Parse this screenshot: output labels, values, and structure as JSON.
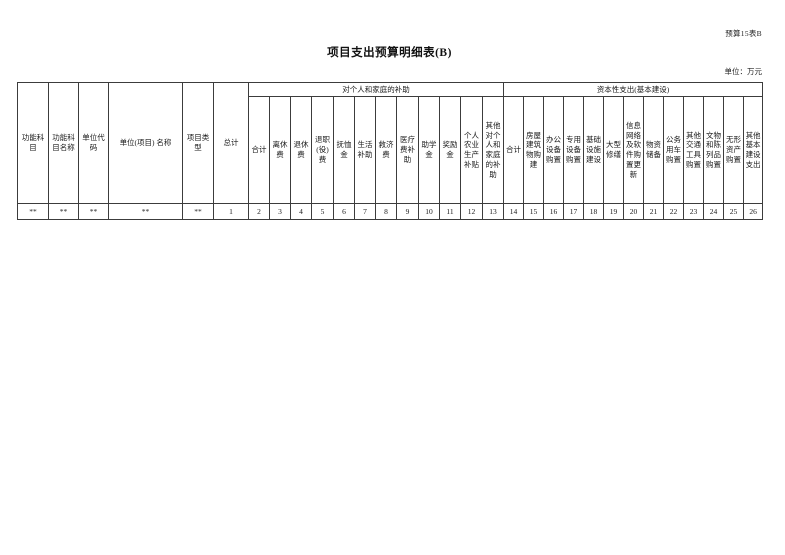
{
  "page": {
    "doc_label": "预算15表B",
    "title": "项目支出预算明细表(B)",
    "unit_note": "单位：万元"
  },
  "table": {
    "fixed_columns": [
      {
        "label": "功能科目",
        "index": "**"
      },
      {
        "label": "功能科目名称",
        "index": "**"
      },
      {
        "label": "单位代码",
        "index": "**"
      },
      {
        "label": "单位(项目) 名称",
        "index": "**"
      },
      {
        "label": "项目类型",
        "index": "**"
      },
      {
        "label": "总计",
        "index": "1"
      }
    ],
    "groups": [
      {
        "label": "对个人和家庭的补助",
        "columns": [
          {
            "label": "合计",
            "index": "2"
          },
          {
            "label": "离休费",
            "index": "3"
          },
          {
            "label": "退休费",
            "index": "4"
          },
          {
            "label": "退职(役)费",
            "index": "5"
          },
          {
            "label": "抚恤金",
            "index": "6"
          },
          {
            "label": "生活补助",
            "index": "7"
          },
          {
            "label": "救济费",
            "index": "8"
          },
          {
            "label": "医疗费补助",
            "index": "9"
          },
          {
            "label": "助学金",
            "index": "10"
          },
          {
            "label": "奖励金",
            "index": "11"
          },
          {
            "label": "个人农业生产补贴",
            "index": "12"
          },
          {
            "label": "其他对个人和家庭的补助",
            "index": "13"
          }
        ]
      },
      {
        "label": "资本性支出(基本建设)",
        "columns": [
          {
            "label": "合计",
            "index": "14"
          },
          {
            "label": "房屋建筑物购建",
            "index": "15"
          },
          {
            "label": "办公设备购置",
            "index": "16"
          },
          {
            "label": "专用设备购置",
            "index": "17"
          },
          {
            "label": "基础设施建设",
            "index": "18"
          },
          {
            "label": "大型修缮",
            "index": "19"
          },
          {
            "label": "信息网络及软件购置更新",
            "index": "20"
          },
          {
            "label": "物资储备",
            "index": "21"
          },
          {
            "label": "公务用车购置",
            "index": "22"
          },
          {
            "label": "其他交通工具购置",
            "index": "23"
          },
          {
            "label": "文物和陈列品购置",
            "index": "24"
          },
          {
            "label": "无形资产购置",
            "index": "25"
          },
          {
            "label": "其他基本建设支出",
            "index": "26"
          }
        ]
      }
    ]
  }
}
